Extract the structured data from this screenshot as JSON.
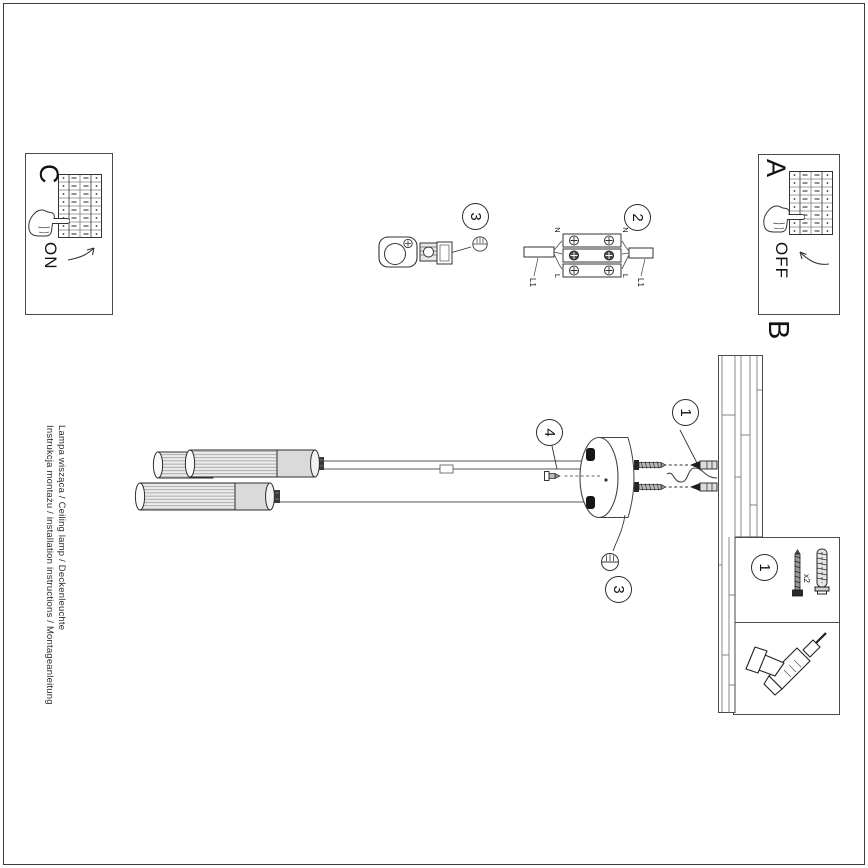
{
  "sections": {
    "a": "A",
    "b": "B",
    "c": "C"
  },
  "switch_on": "ON",
  "switch_off": "OFF",
  "callouts": {
    "one": "1",
    "two": "2",
    "three": "3",
    "four": "4"
  },
  "wiring": {
    "n": "N",
    "l": "L",
    "l1": "L1"
  },
  "parts": {
    "qty": "x2"
  },
  "footer": {
    "line1": "Lampa wisząca / Ceiling lamp / Deckenleuchte",
    "line2": "Instrukcja montażu / installation instructions / Montageanleitung"
  }
}
